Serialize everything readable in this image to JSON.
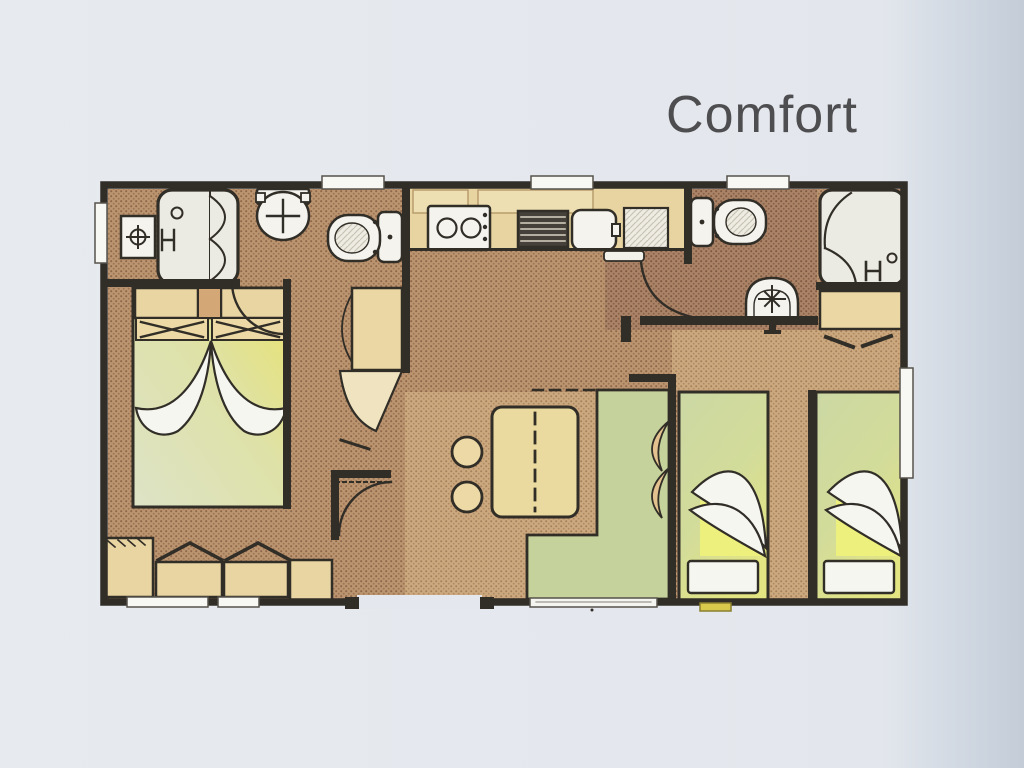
{
  "page": {
    "background": "#e3e7ed",
    "background_right_edge": "#c4ccd8"
  },
  "title": {
    "text": "Comfort",
    "color": "#4e4e50"
  },
  "plan": {
    "type": "mobile-home floor plan, top view, scanned drawing",
    "colors": {
      "wall": "#312d27",
      "floor_light_tan": "#cca87e",
      "floor_mid_brown": "#bb9470",
      "floor_dark_brown": "#ab8367",
      "furniture_tan": "#e9d5a2",
      "counter_tan": "#e8d4a0",
      "bench_green": "#c6d29b",
      "bed_green": "#ccd8a4",
      "bed_yellow": "#e9e36e",
      "fixture_white": "#f4f3ee",
      "shower_gray": "#ebebe3",
      "linen_white": "#f6f6f1",
      "step_yellow": "#d8c94c"
    },
    "rooms": [
      {
        "name": "bathroom-left",
        "fixtures": [
          "shower-cabin",
          "vanity-basin-unit",
          "wall-washbasin"
        ]
      },
      {
        "name": "wc-left",
        "fixtures": [
          "toilet"
        ]
      },
      {
        "name": "master-bedroom",
        "fixtures": [
          "double-bed",
          "headboard-shelves",
          "two-pillows",
          "wardrobe-units",
          "corner-cabinet"
        ]
      },
      {
        "name": "kitchen",
        "fixtures": [
          "wall-cabinets",
          "hob-two-burners",
          "grill",
          "sink",
          "drainer",
          "tall-cabinet-fridge"
        ]
      },
      {
        "name": "living-dining",
        "fixtures": [
          "extendable-table",
          "stool",
          "stool",
          "l-shaped-bench",
          "bench-cushions"
        ]
      },
      {
        "name": "bathroom-right",
        "fixtures": [
          "toilet",
          "wall-washbasin",
          "shower-cabin",
          "wardrobe-under-shower"
        ]
      },
      {
        "name": "twin-bedroom",
        "fixtures": [
          "single-bed-left",
          "single-bed-right",
          "pillow",
          "pillow"
        ]
      }
    ],
    "openings": {
      "top_windows": 3,
      "bottom_windows": 2,
      "left_window": 1,
      "right_window": 1,
      "entrance_opening": 1,
      "sliding_window_behind_bench": 1,
      "interior_door_arcs": 4,
      "yellow_entry_step": 1
    }
  }
}
